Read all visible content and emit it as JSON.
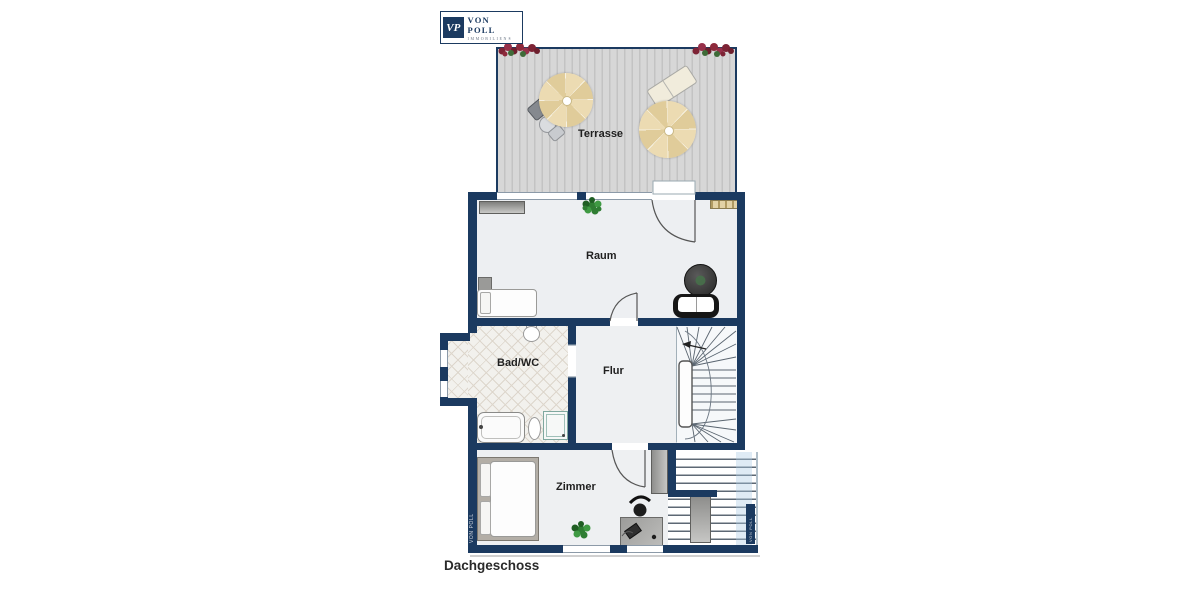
{
  "logo": {
    "initials": "VP",
    "brand": "VON POLL",
    "subtitle": "IMMOBILIEN®"
  },
  "floor_label": "Dachgeschoss",
  "watermark_left": "VON POLL",
  "watermark_right": "VON POLL",
  "rooms": {
    "terrasse": {
      "label": "Terrasse"
    },
    "raum": {
      "label": "Raum"
    },
    "bad": {
      "label": "Bad/WC"
    },
    "flur": {
      "label": "Flur"
    },
    "zimmer": {
      "label": "Zimmer"
    }
  },
  "colors": {
    "wall": "#1b3a60",
    "deck": "#d6d6d6",
    "floor": "#edeff2",
    "tile": "#f2f1ed",
    "parasol": "#e8d5a8",
    "flower": "#8e2a3c",
    "plant": "#2e7d32"
  }
}
